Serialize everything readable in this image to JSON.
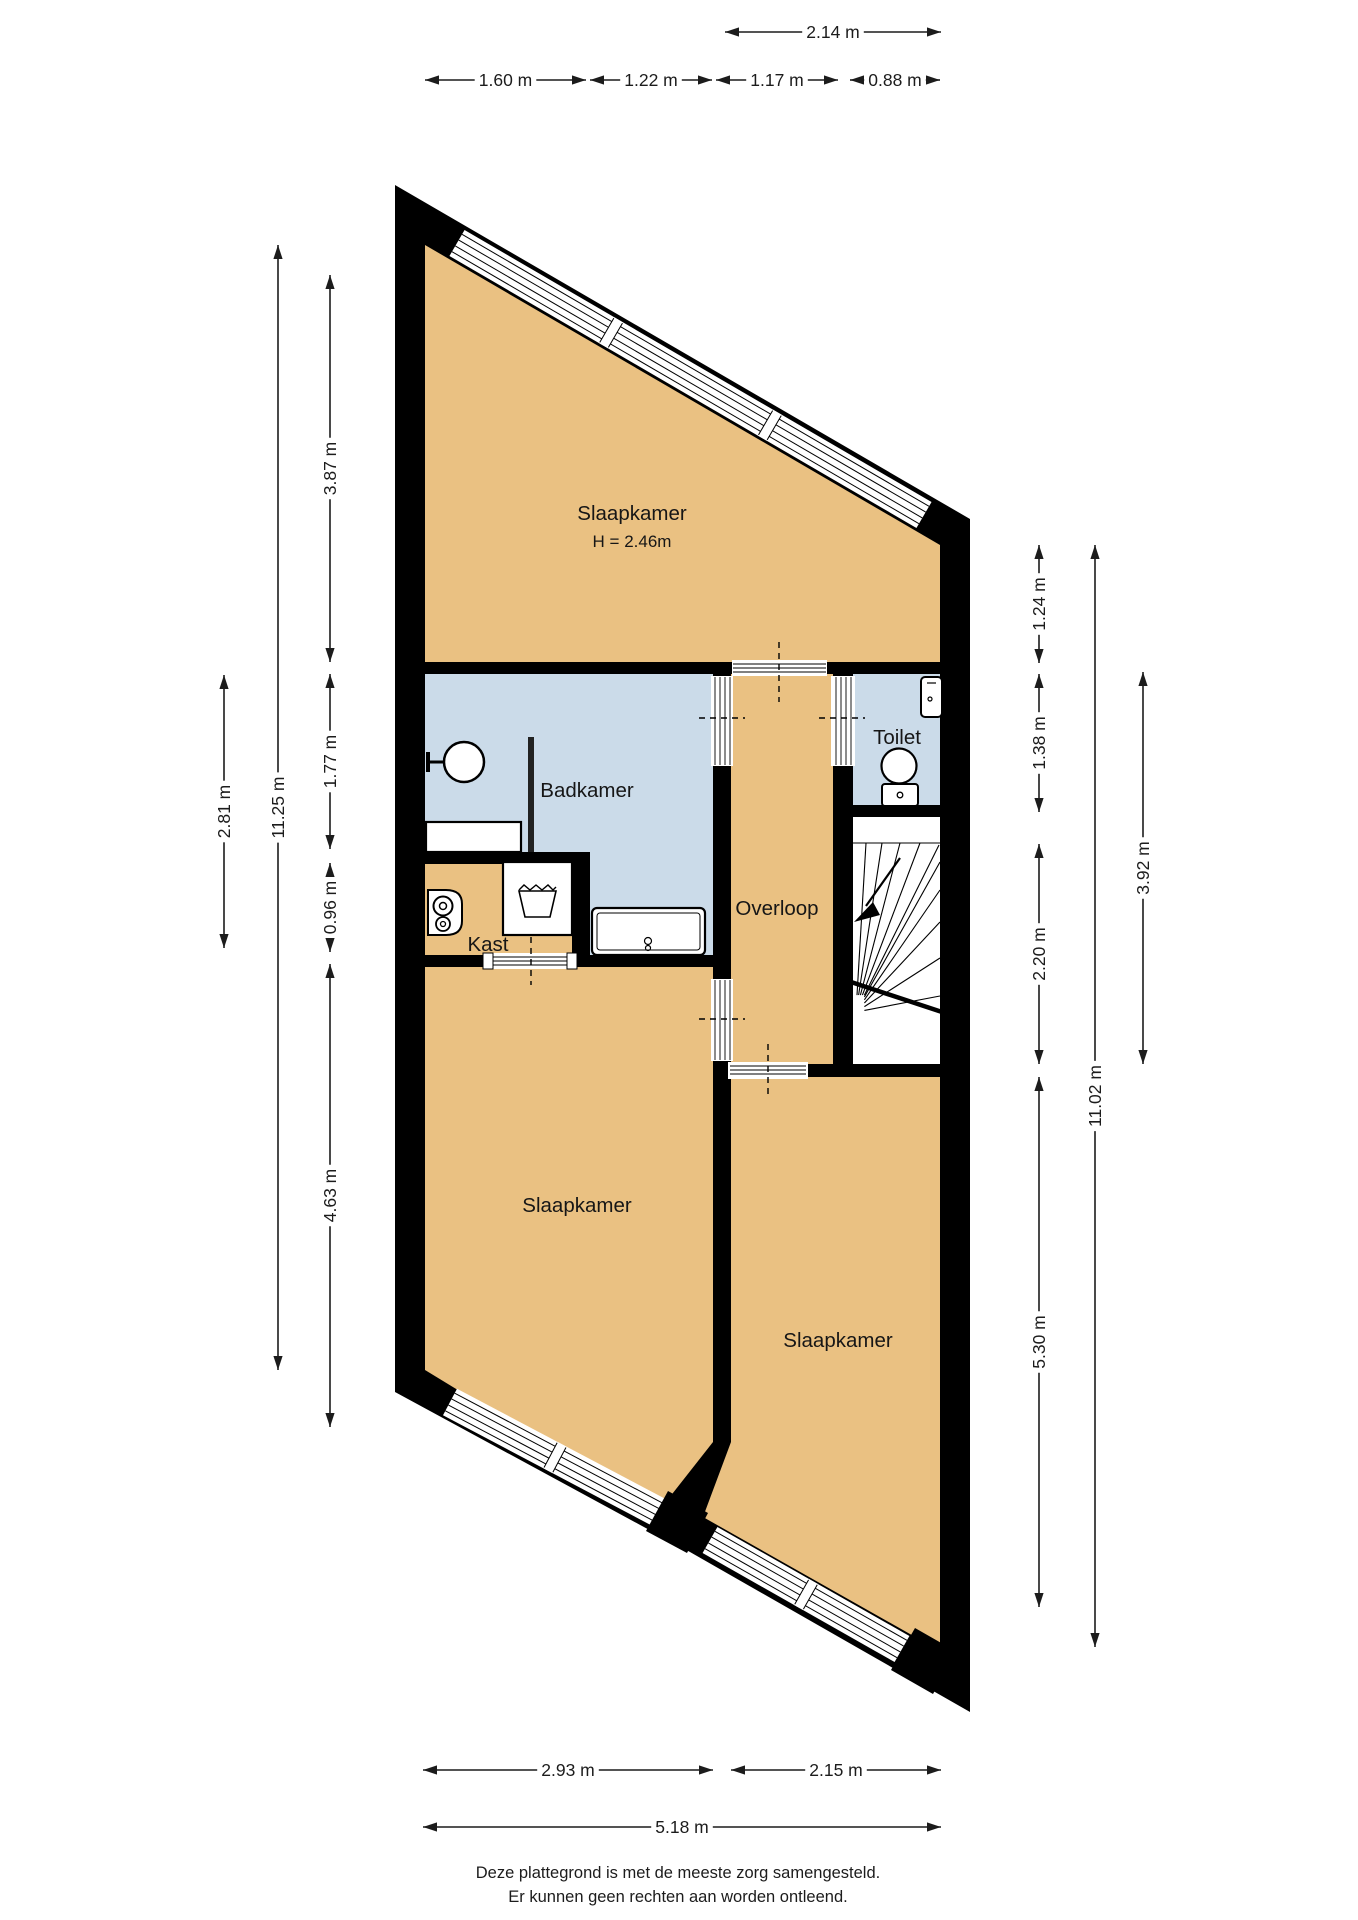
{
  "title": "Floor plan (plattegrond) - verdieping",
  "rooms": {
    "slaapkamer_top": {
      "label": "Slaapkamer",
      "height_note": "H = 2.46m"
    },
    "badkamer": {
      "label": "Badkamer"
    },
    "toilet": {
      "label": "Toilet"
    },
    "overloop": {
      "label": "Overloop"
    },
    "kast": {
      "label": "Kast"
    },
    "slaapkamer_left": {
      "label": "Slaapkamer"
    },
    "slaapkamer_right": {
      "label": "Slaapkamer"
    }
  },
  "dimensions": {
    "t214": "2.14 m",
    "t160": "1.60 m",
    "t122": "1.22 m",
    "t117": "1.17 m",
    "t088": "0.88 m",
    "l281": "2.81 m",
    "l1125": "11.25 m",
    "l387": "3.87 m",
    "l177": "1.77 m",
    "l096": "0.96 m",
    "l463": "4.63 m",
    "r124": "1.24 m",
    "r138": "1.38 m",
    "r220": "2.20 m",
    "r530": "5.30 m",
    "r1102": "11.02 m",
    "r392": "3.92 m",
    "b293": "2.93 m",
    "b215": "2.15 m",
    "b518": "5.18 m"
  },
  "footer": {
    "line1": "Deze plattegrond is met de meeste zorg samengesteld.",
    "line2": "Er kunnen geen rechten aan worden ontleend."
  },
  "colors": {
    "wall": "#000000",
    "room_tan": "#eac182",
    "room_blue": "#cbdbe9",
    "stair_white": "#ffffff"
  }
}
